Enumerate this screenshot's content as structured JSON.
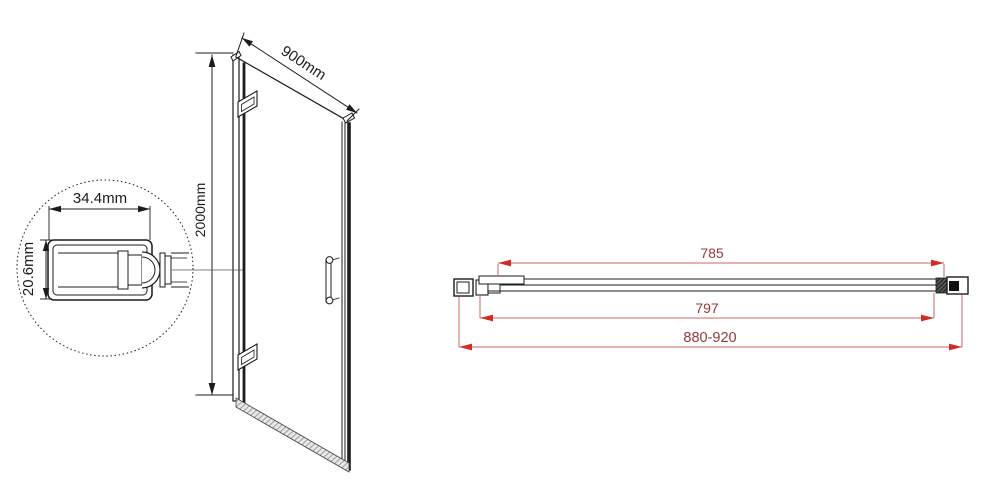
{
  "front_view": {
    "width_label": "900mm",
    "height_label": "2000mm",
    "detail": {
      "width_label": "34.4mm",
      "height_label": "20.6mm"
    }
  },
  "top_view": {
    "glass_width_label": "785",
    "door_width_label": "797",
    "adjustment_range_label": "880-920"
  },
  "colors": {
    "line_black": "#1c1c1c",
    "dim_red_line": "#bf6a64",
    "dim_red_arrow": "#cf2b27",
    "dim_red_text": "#8e3b3b",
    "background": "#ffffff"
  }
}
